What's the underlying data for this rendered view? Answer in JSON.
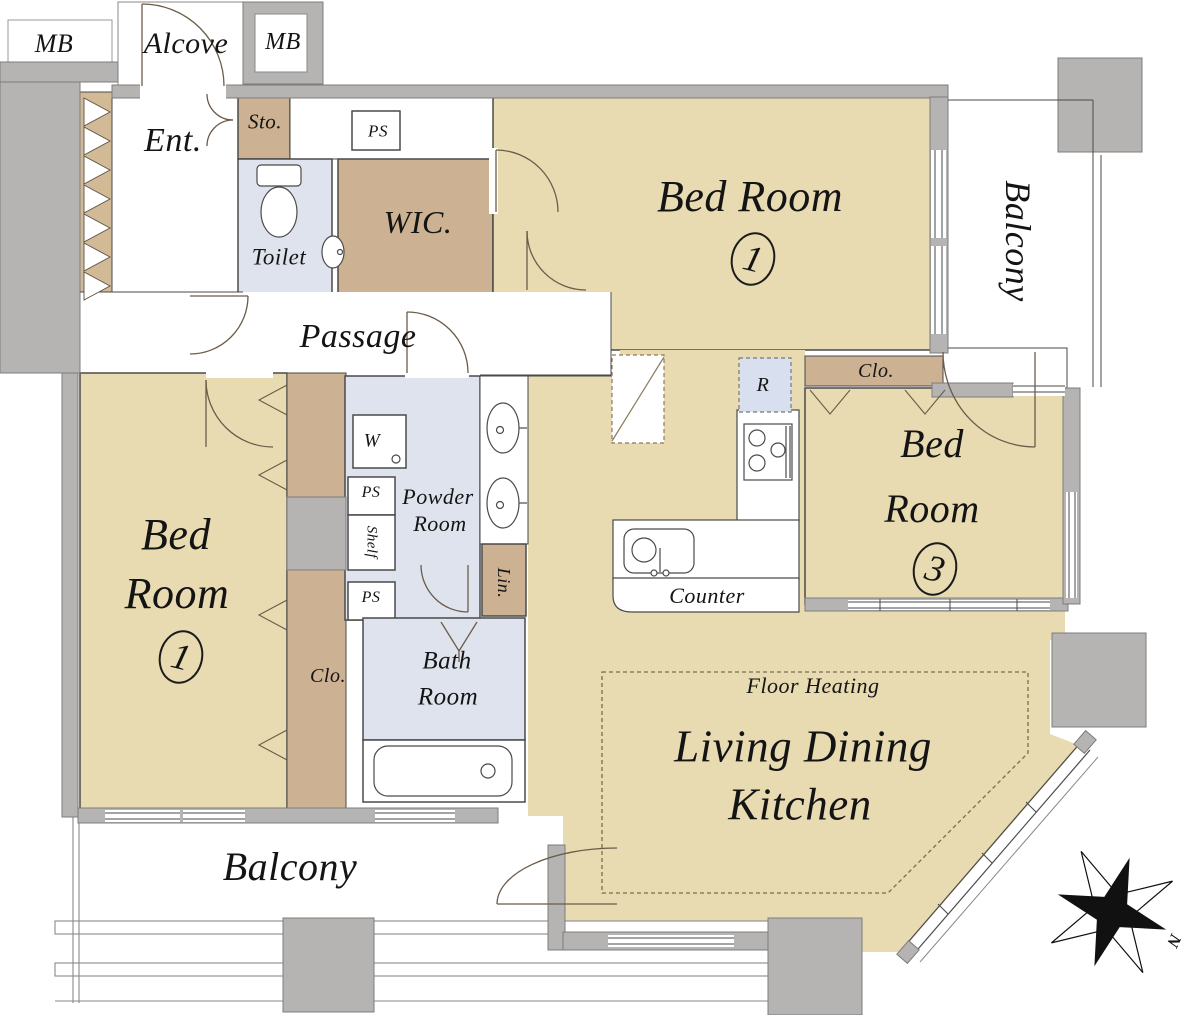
{
  "colors": {
    "room_tan": "#e8dbb2",
    "closet_tan": "#ccb292",
    "entry_strip_tan": "#d2ba96",
    "wet_area_blue": "#dfe3ee",
    "refrigerator_blue": "#d8dfee",
    "wall_gray": "#b5b4b3",
    "line": "#4a4a4a",
    "door_line": "#6b5c49"
  },
  "labels": {
    "mb_left": "MB",
    "alcove": "Alcove",
    "mb_right": "MB",
    "entrance": "Ent.",
    "storage": "Sto.",
    "ps_top": "PS",
    "toilet": "Toilet",
    "wic": "WIC.",
    "bedroom1_name": "Bed Room",
    "bedroom1_number": "1",
    "balcony_right": "Balcony",
    "passage": "Passage",
    "refrigerator": "R",
    "closet_bedroom3": "Clo.",
    "bedroom3_line1": "Bed",
    "bedroom3_line2": "Room",
    "bedroom3_number": "3",
    "washer": "W",
    "ps_mid_upper": "PS",
    "shelf": "Shelf",
    "ps_mid_lower": "PS",
    "powder_line1": "Powder",
    "powder_line2": "Room",
    "linen": "Lin.",
    "counter": "Counter",
    "bedroom2_line1": "Bed",
    "bedroom2_line2": "Room",
    "bedroom2_number": "1",
    "closet_bedroom2": "Clo.",
    "bath_line1": "Bath",
    "bath_line2": "Room",
    "floor_heating": "Floor Heating",
    "ldk_line1": "Living Dining",
    "ldk_line2": "Kitchen",
    "balcony_bottom": "Balcony",
    "compass_north": "N"
  }
}
